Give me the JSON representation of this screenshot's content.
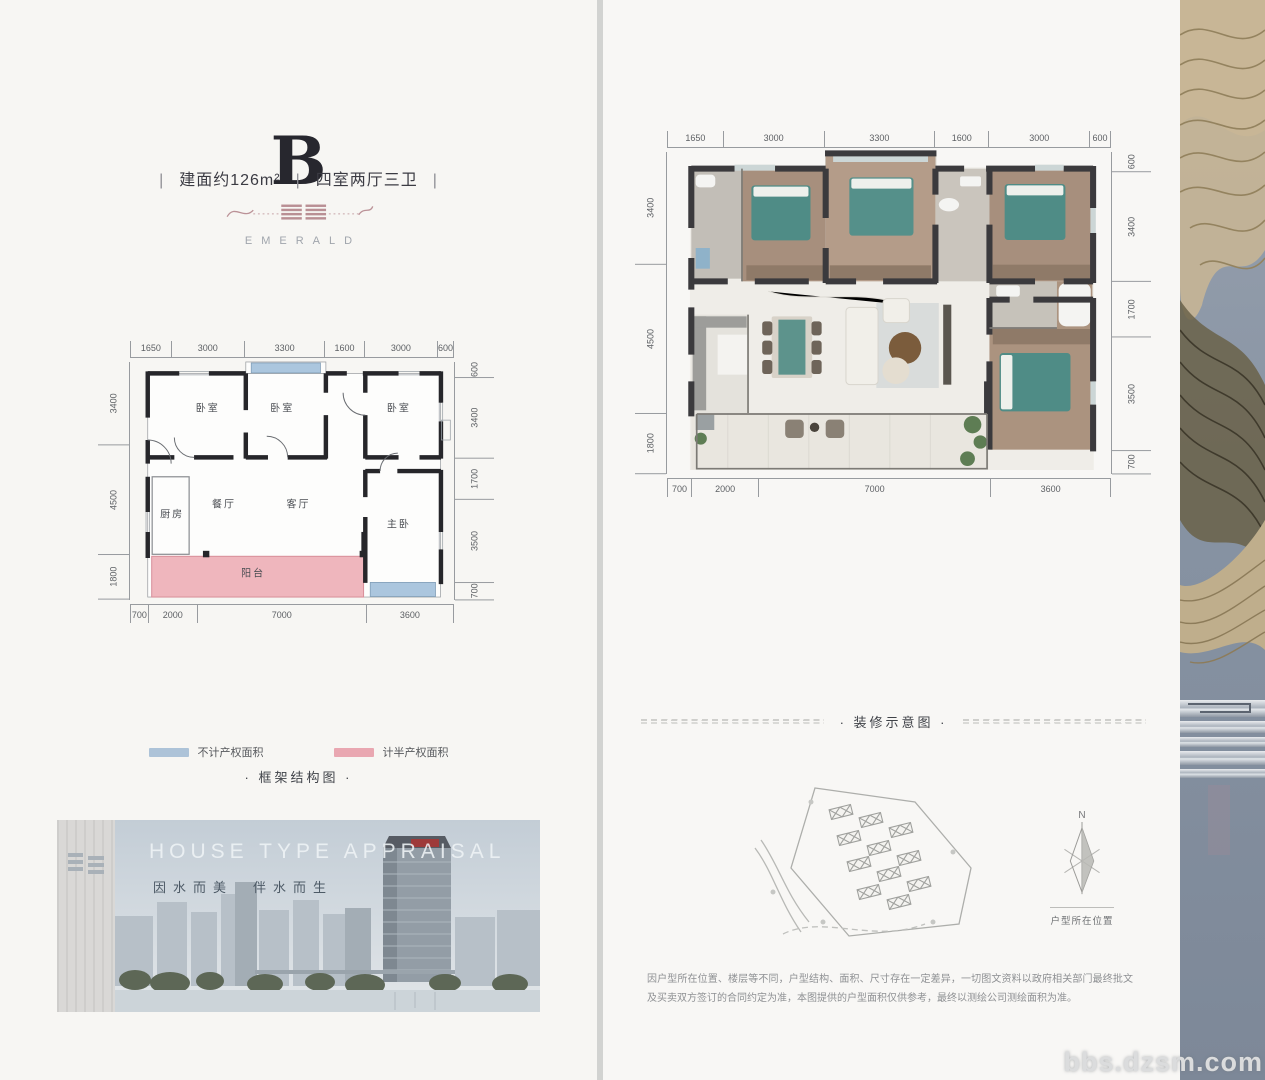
{
  "watermark": "bbs.dzsm.com",
  "left_page": {
    "title": "B",
    "spec": {
      "sep": "|",
      "area": "建面约126m²",
      "layout": "四室两厅三卫"
    },
    "brand": {
      "name": "EMERALD"
    },
    "legend": {
      "items": [
        {
          "label": "不计产权面积",
          "color": "#adc3d8"
        },
        {
          "label": "计半产权面积",
          "color": "#e9a7b1"
        }
      ]
    },
    "caption": "· 框架结构图 ·",
    "photo": {
      "heading": "HOUSE TYPE APPRAISAL",
      "slogan": "因水而美　伴水而生"
    }
  },
  "right_page": {
    "caption": "· 装修示意图 ·",
    "siteplan": {
      "north": "N",
      "location": "户型所在位置"
    },
    "disclaimer": "因户型所在位置、楼层等不同，户型结构、面积、尺寸存在一定差异，一切图文资料以政府相关部门最终批文及买卖双方签订的合同约定为准，本图提供的户型面积仅供参考，最终以测绘公司测绘面积为准。"
  },
  "floorplan": {
    "rooms": [
      {
        "label": "卧室",
        "x": 24,
        "y": 20
      },
      {
        "label": "卧室",
        "x": 47,
        "y": 20
      },
      {
        "label": "卧室",
        "x": 83,
        "y": 20
      },
      {
        "label": "厨房",
        "x": 13,
        "y": 63
      },
      {
        "label": "餐厅",
        "x": 29,
        "y": 59
      },
      {
        "label": "客厅",
        "x": 52,
        "y": 59
      },
      {
        "label": "主卧",
        "x": 83,
        "y": 67
      },
      {
        "label": "阳台",
        "x": 38,
        "y": 87
      }
    ],
    "dims": {
      "top": [
        {
          "label": "1650",
          "flex": 1650
        },
        {
          "label": "3000",
          "flex": 3000
        },
        {
          "label": "3300",
          "flex": 3300
        },
        {
          "label": "1600",
          "flex": 1600
        },
        {
          "label": "3000",
          "flex": 3000
        },
        {
          "label": "600",
          "flex": 600
        }
      ],
      "bottom": [
        {
          "label": "700",
          "flex": 700
        },
        {
          "label": "2000",
          "flex": 2000
        },
        {
          "label": "7000",
          "flex": 7000
        },
        {
          "label": "3600",
          "flex": 3600
        }
      ],
      "left": [
        {
          "label": "3400",
          "flex": 3400
        },
        {
          "label": "4500",
          "flex": 4500
        },
        {
          "label": "1800",
          "flex": 1800
        }
      ],
      "right": [
        {
          "label": "600",
          "flex": 600
        },
        {
          "label": "3400",
          "flex": 3400
        },
        {
          "label": "1700",
          "flex": 1700
        },
        {
          "label": "3500",
          "flex": 3500
        },
        {
          "label": "700",
          "flex": 700
        }
      ]
    }
  }
}
